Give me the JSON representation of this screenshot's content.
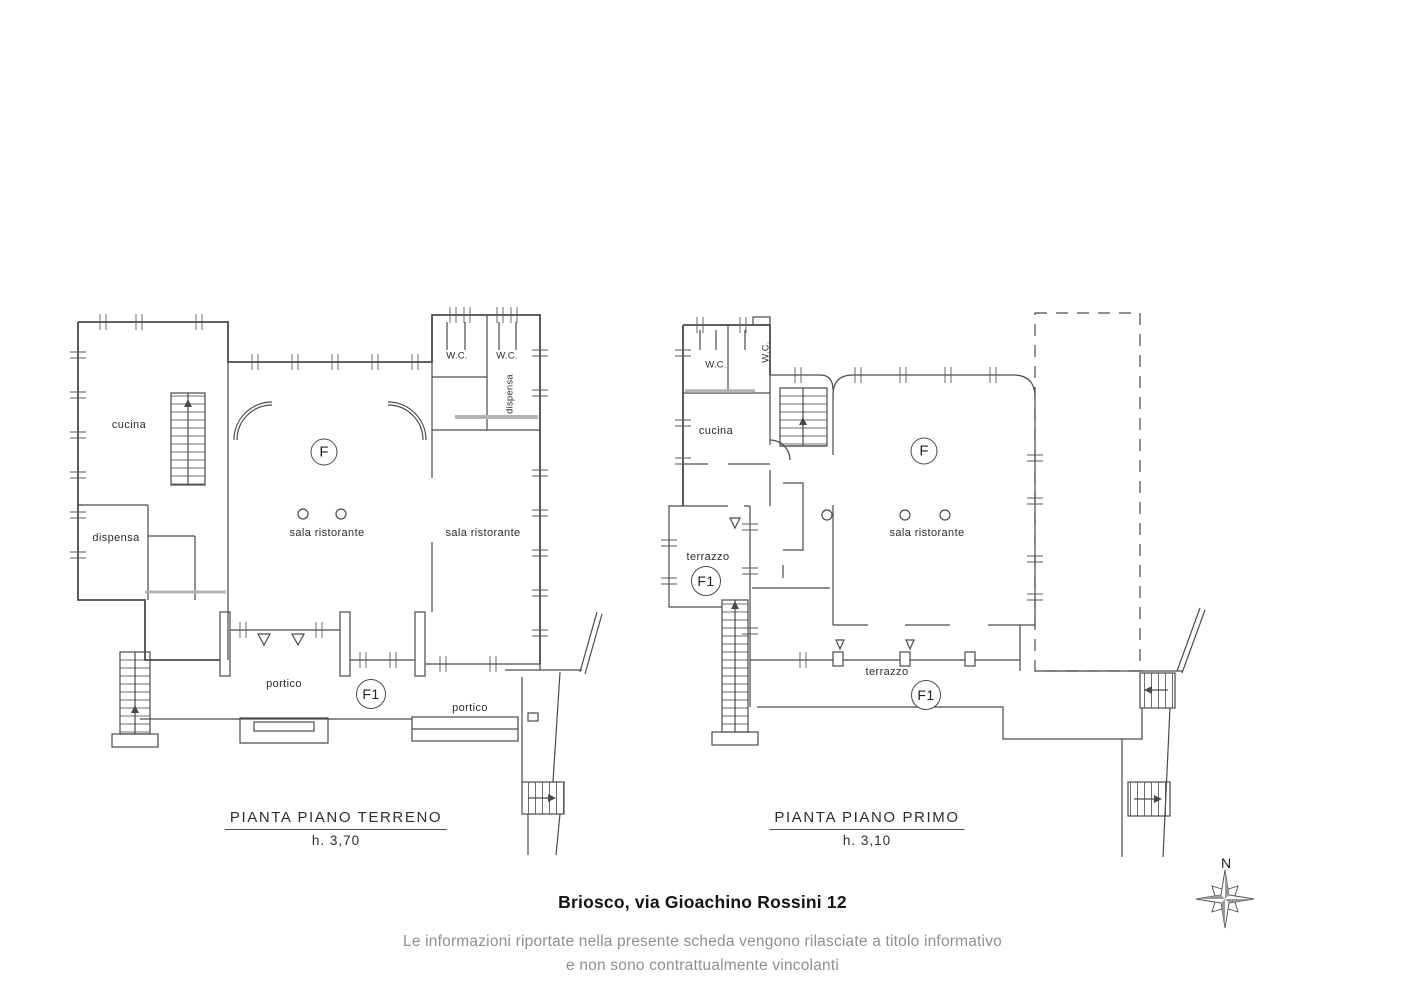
{
  "sheet": {
    "background_color": "#ffffff",
    "line_color": "#4a4a4a",
    "soft_wall_color": "#b3b3b3",
    "disclaimer_text_color": "#8f8f8f",
    "address": "Briosco, via Gioachino Rossini 12",
    "disclaimer_line1": "Le informazioni riportate nella presente scheda vengono rilasciate a titolo informativo",
    "disclaimer_line2": "e non sono contrattualmente vincolanti",
    "compass": {
      "icon": "compass-rose-icon",
      "label": "N"
    }
  },
  "plans": [
    {
      "key": "piano-terreno",
      "title": "PIANTA PIANO TERRENO",
      "height_label": "h. 3,70",
      "rooms": [
        {
          "label": "cucina"
        },
        {
          "label": "dispensa"
        },
        {
          "label": "sala ristorante"
        },
        {
          "label": "sala ristorante"
        },
        {
          "label": "W.C."
        },
        {
          "label": "W.C."
        },
        {
          "label": "dispensa"
        },
        {
          "label": "portico"
        },
        {
          "label": "portico"
        }
      ],
      "markers": [
        {
          "label": "F"
        },
        {
          "label": "F1"
        }
      ]
    },
    {
      "key": "piano-primo",
      "title": "PIANTA PIANO PRIMO",
      "height_label": "h. 3,10",
      "rooms": [
        {
          "label": "W.C."
        },
        {
          "label": "W.C."
        },
        {
          "label": "cucina"
        },
        {
          "label": "terrazzo"
        },
        {
          "label": "sala ristorante"
        },
        {
          "label": "terrazzo"
        }
      ],
      "markers": [
        {
          "label": "F"
        },
        {
          "label": "F1"
        },
        {
          "label": "F1"
        }
      ]
    }
  ]
}
